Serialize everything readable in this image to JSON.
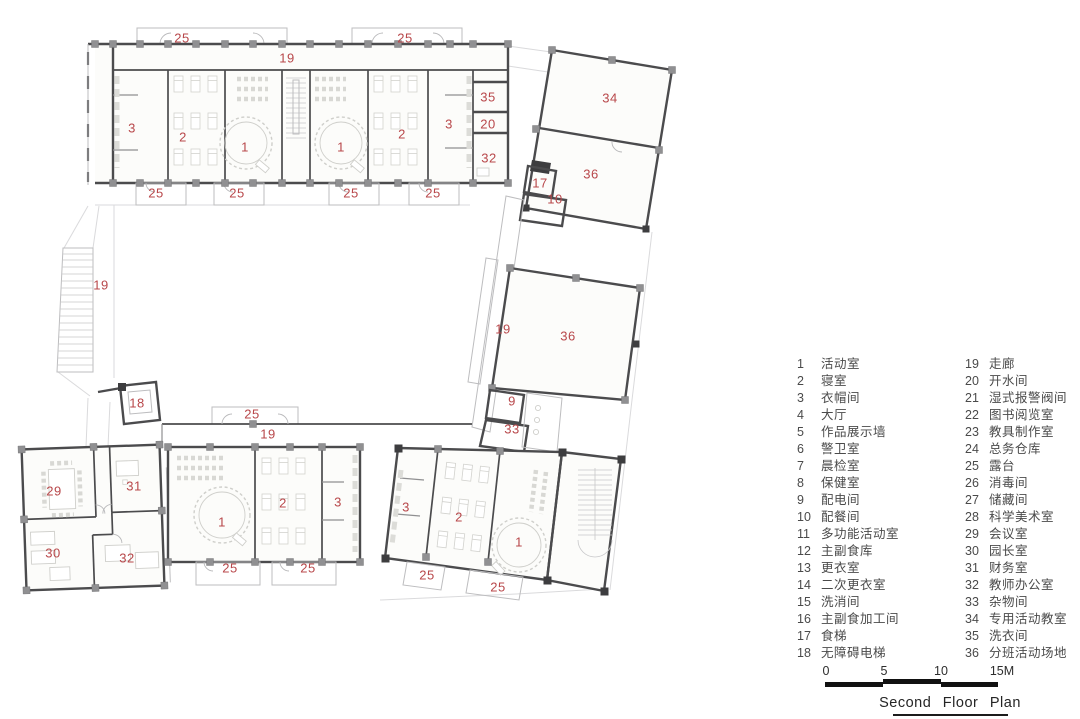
{
  "title": "Second Floor Plan",
  "colors": {
    "wall": "#4b4b4d",
    "room_label": "#b8474a",
    "furniture": "#cfcfcb",
    "legend_text": "#4a4a4a"
  },
  "plan": {
    "room_labels": [
      {
        "t": "25",
        "x": 182,
        "y": 38
      },
      {
        "t": "25",
        "x": 405,
        "y": 38
      },
      {
        "t": "19",
        "x": 287,
        "y": 58
      },
      {
        "t": "3",
        "x": 132,
        "y": 128
      },
      {
        "t": "2",
        "x": 183,
        "y": 137
      },
      {
        "t": "1",
        "x": 245,
        "y": 147
      },
      {
        "t": "1",
        "x": 341,
        "y": 147
      },
      {
        "t": "2",
        "x": 402,
        "y": 134
      },
      {
        "t": "3",
        "x": 449,
        "y": 124
      },
      {
        "t": "35",
        "x": 488,
        "y": 97
      },
      {
        "t": "20",
        "x": 488,
        "y": 124
      },
      {
        "t": "32",
        "x": 489,
        "y": 158
      },
      {
        "t": "25",
        "x": 156,
        "y": 193
      },
      {
        "t": "25",
        "x": 237,
        "y": 193
      },
      {
        "t": "25",
        "x": 351,
        "y": 193
      },
      {
        "t": "25",
        "x": 433,
        "y": 193
      },
      {
        "t": "34",
        "x": 610,
        "y": 98
      },
      {
        "t": "36",
        "x": 591,
        "y": 174
      },
      {
        "t": "17",
        "x": 540,
        "y": 183
      },
      {
        "t": "10",
        "x": 555,
        "y": 199
      },
      {
        "t": "19",
        "x": 101,
        "y": 285
      },
      {
        "t": "19",
        "x": 503,
        "y": 329
      },
      {
        "t": "36",
        "x": 568,
        "y": 336
      },
      {
        "t": "9",
        "x": 512,
        "y": 401
      },
      {
        "t": "33",
        "x": 512,
        "y": 429
      },
      {
        "t": "18",
        "x": 137,
        "y": 403
      },
      {
        "t": "25",
        "x": 252,
        "y": 414
      },
      {
        "t": "19",
        "x": 268,
        "y": 434
      },
      {
        "t": "29",
        "x": 54,
        "y": 491
      },
      {
        "t": "31",
        "x": 134,
        "y": 486
      },
      {
        "t": "30",
        "x": 53,
        "y": 553
      },
      {
        "t": "32",
        "x": 127,
        "y": 558
      },
      {
        "t": "1",
        "x": 222,
        "y": 522
      },
      {
        "t": "2",
        "x": 283,
        "y": 503
      },
      {
        "t": "3",
        "x": 338,
        "y": 502
      },
      {
        "t": "25",
        "x": 230,
        "y": 568
      },
      {
        "t": "25",
        "x": 308,
        "y": 568
      },
      {
        "t": "3",
        "x": 406,
        "y": 507
      },
      {
        "t": "2",
        "x": 459,
        "y": 517
      },
      {
        "t": "1",
        "x": 519,
        "y": 542
      },
      {
        "t": "25",
        "x": 427,
        "y": 575
      },
      {
        "t": "25",
        "x": 498,
        "y": 587
      }
    ]
  },
  "legend": {
    "column1": [
      {
        "num": "1",
        "label": "活动室"
      },
      {
        "num": "2",
        "label": "寝室"
      },
      {
        "num": "3",
        "label": "衣帽间"
      },
      {
        "num": "4",
        "label": "大厅"
      },
      {
        "num": "5",
        "label": "作品展示墙"
      },
      {
        "num": "6",
        "label": "警卫室"
      },
      {
        "num": "7",
        "label": "晨检室"
      },
      {
        "num": "8",
        "label": "保健室"
      },
      {
        "num": "9",
        "label": "配电间"
      },
      {
        "num": "10",
        "label": "配餐间"
      },
      {
        "num": "11",
        "label": "多功能活动室"
      },
      {
        "num": "12",
        "label": "主副食库"
      },
      {
        "num": "13",
        "label": "更衣室"
      },
      {
        "num": "14",
        "label": "二次更衣室"
      },
      {
        "num": "15",
        "label": "洗消间"
      },
      {
        "num": "16",
        "label": "主副食加工间"
      },
      {
        "num": "17",
        "label": "食梯"
      },
      {
        "num": "18",
        "label": "无障碍电梯"
      }
    ],
    "column2": [
      {
        "num": "19",
        "label": "走廊"
      },
      {
        "num": "20",
        "label": "开水间"
      },
      {
        "num": "21",
        "label": "湿式报警阀间"
      },
      {
        "num": "22",
        "label": "图书阅览室"
      },
      {
        "num": "23",
        "label": "教具制作室"
      },
      {
        "num": "24",
        "label": "总务仓库"
      },
      {
        "num": "25",
        "label": "露台"
      },
      {
        "num": "26",
        "label": "消毒间"
      },
      {
        "num": "27",
        "label": "储藏间"
      },
      {
        "num": "28",
        "label": "科学美术室"
      },
      {
        "num": "29",
        "label": "会议室"
      },
      {
        "num": "30",
        "label": "园长室"
      },
      {
        "num": "31",
        "label": "财务室"
      },
      {
        "num": "32",
        "label": "教师办公室"
      },
      {
        "num": "33",
        "label": "杂物间"
      },
      {
        "num": "34",
        "label": "专用活动教室"
      },
      {
        "num": "35",
        "label": "洗衣间"
      },
      {
        "num": "36",
        "label": "分班活动场地"
      }
    ]
  },
  "scale_bar": {
    "labels": [
      {
        "t": "0",
        "x": 826
      },
      {
        "t": "5",
        "x": 884
      },
      {
        "t": "10",
        "x": 941
      },
      {
        "t": "15M",
        "x": 1002
      }
    ]
  }
}
